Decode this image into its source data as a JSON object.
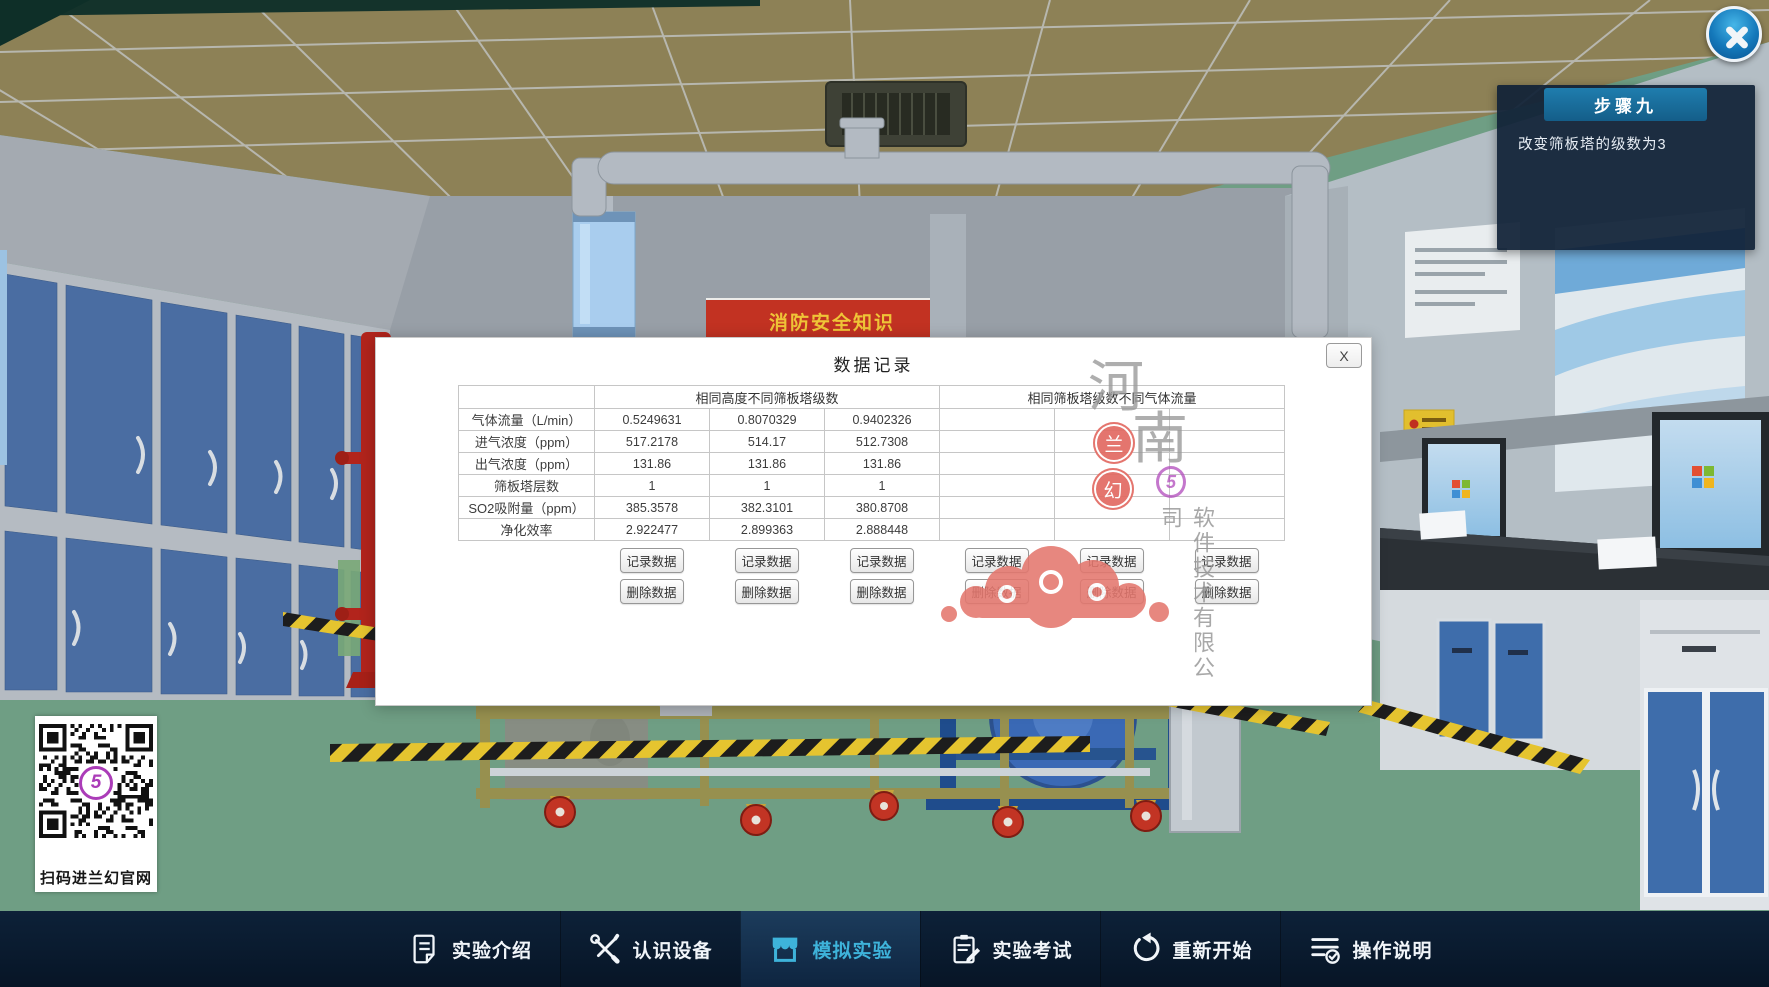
{
  "scene": {
    "poster_title": "消防安全知识",
    "qr_caption": "扫码进兰幻官网"
  },
  "step_panel": {
    "title": "步骤九",
    "description": "改变筛板塔的级数为3"
  },
  "dialog": {
    "title": "数据记录",
    "close_label": "X",
    "record_button_label": "记录数据",
    "delete_button_label": "删除数据",
    "table": {
      "group_headers": [
        "相同高度不同筛板塔级数",
        "相同筛板塔级数不同气体流量"
      ],
      "rows": [
        {
          "label": "气体流量（L/min）",
          "values": [
            "0.5249631",
            "0.8070329",
            "0.9402326",
            "",
            "",
            ""
          ]
        },
        {
          "label": "进气浓度（ppm）",
          "values": [
            "517.2178",
            "514.17",
            "512.7308",
            "",
            "",
            ""
          ]
        },
        {
          "label": "出气浓度（ppm）",
          "values": [
            "131.86",
            "131.86",
            "131.86",
            "",
            "",
            ""
          ]
        },
        {
          "label": "筛板塔层数",
          "values": [
            "1",
            "1",
            "1",
            "",
            "",
            ""
          ]
        },
        {
          "label": "SO2吸附量（ppm）",
          "values": [
            "385.3578",
            "382.3101",
            "380.8708",
            "",
            "",
            ""
          ]
        },
        {
          "label": "净化效率",
          "values": [
            "2.922477",
            "2.899363",
            "2.888448",
            "",
            "",
            ""
          ]
        }
      ]
    },
    "watermark": {
      "char_top": "河",
      "char_bottom": "南",
      "stamp1": "兰",
      "stamp2": "幻",
      "logo_glyph": "5",
      "vertical_text": "软件技术有限公司"
    }
  },
  "nav": {
    "items": [
      {
        "label": "实验介绍"
      },
      {
        "label": "认识设备"
      },
      {
        "label": "模拟实验"
      },
      {
        "label": "实验考试"
      },
      {
        "label": "重新开始"
      },
      {
        "label": "操作说明"
      }
    ]
  },
  "colors": {
    "accent_teal": "#3eb3da",
    "step_header_blue": "#1b6f9b",
    "nav_bg": "#0a1c30",
    "stamp_red": "#e26a62",
    "logo_purple": "#b14abc",
    "hazard_yellow": "#e5c42f",
    "locker_blue": "#4a6da2",
    "floor_green": "#6f9e84"
  }
}
